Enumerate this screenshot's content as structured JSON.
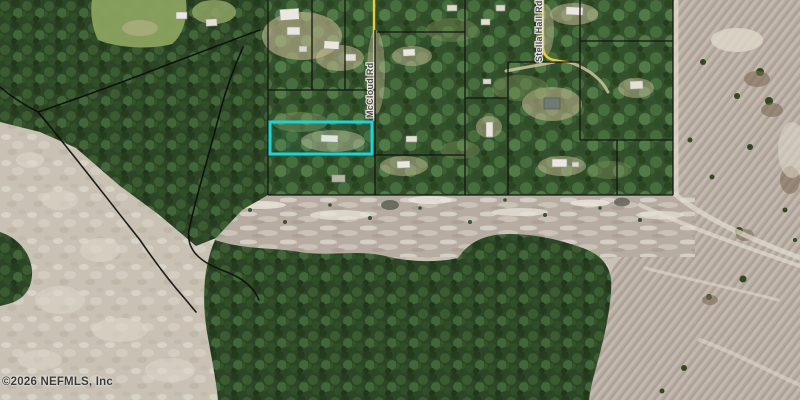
{
  "map": {
    "attribution": "©2026 NEFMLS, Inc",
    "roads": [
      {
        "label": "McCloud Rd"
      },
      {
        "label": "Stella Hall Rd"
      }
    ],
    "highlighted_parcel": {
      "outline_color": "#1bd4d4"
    },
    "colors": {
      "parcel_line": "#151515",
      "trail": "#0e0e0e",
      "road_yellow": "#e7cf3c",
      "forest_dark": "#2c4526",
      "field_green": "#8ba25f",
      "sand": "#cac3b5",
      "cleared_mauve": "#b5aaa0",
      "attribution_text": "#3a3a38"
    }
  }
}
